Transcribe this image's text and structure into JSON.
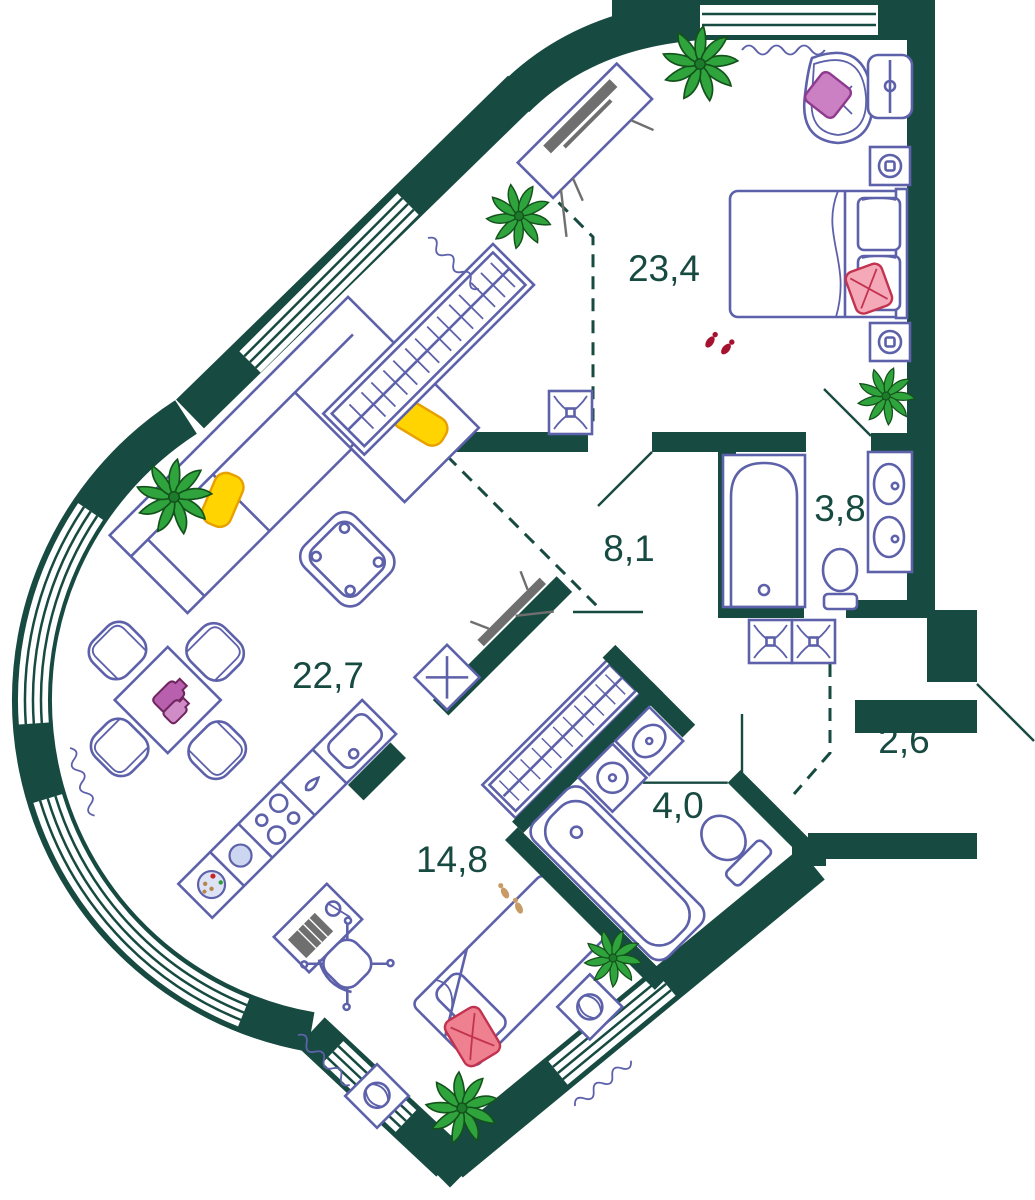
{
  "plan": {
    "type": "apartment-floor-plan",
    "rooms": [
      {
        "id": "bedroom",
        "area_label": "23,4"
      },
      {
        "id": "hallway",
        "area_label": "8,1"
      },
      {
        "id": "bathroom",
        "area_label": "3,8"
      },
      {
        "id": "living-kitchen",
        "area_label": "22,7"
      },
      {
        "id": "entry",
        "area_label": "2,6"
      },
      {
        "id": "bedroom-2",
        "area_label": "14,8"
      },
      {
        "id": "bathroom-2",
        "area_label": "4,0"
      }
    ],
    "colors": {
      "wall": "#174a41",
      "furniture_outline": "#5d61aa",
      "label_text": "#174a41",
      "plant_green": "#2fa43d",
      "pillow_yellow": "#ffd400",
      "pillow_pink": "#cc80c4",
      "pillow_red": "#f5a9b8",
      "vase_magenta": "#b85fae",
      "slippers_red": "#a51230",
      "footprints_tan": "#c89a66",
      "tv_gray": "#6f6f6f",
      "fill_light_blue": "#ccd6f0"
    },
    "icons": [
      "double-bed-icon",
      "single-bed-icon",
      "corner-sofa-icon",
      "armchair-icon",
      "coffee-table-icon",
      "dining-table-icon",
      "chair-icon",
      "wardrobe-hangers-icon",
      "kitchen-counter-icon",
      "sink-icon",
      "hob-icon",
      "bathtub-icon",
      "toilet-icon",
      "double-sink-vanity-icon",
      "washing-machine-icon",
      "desk-icon",
      "office-chair-icon",
      "tv-icon",
      "plant-icon",
      "vent-shaft-icon",
      "socket-icon",
      "radiator-icon",
      "door-swing-icon",
      "window-icon",
      "slippers-icon",
      "footprints-icon",
      "plus-box-icon"
    ]
  }
}
